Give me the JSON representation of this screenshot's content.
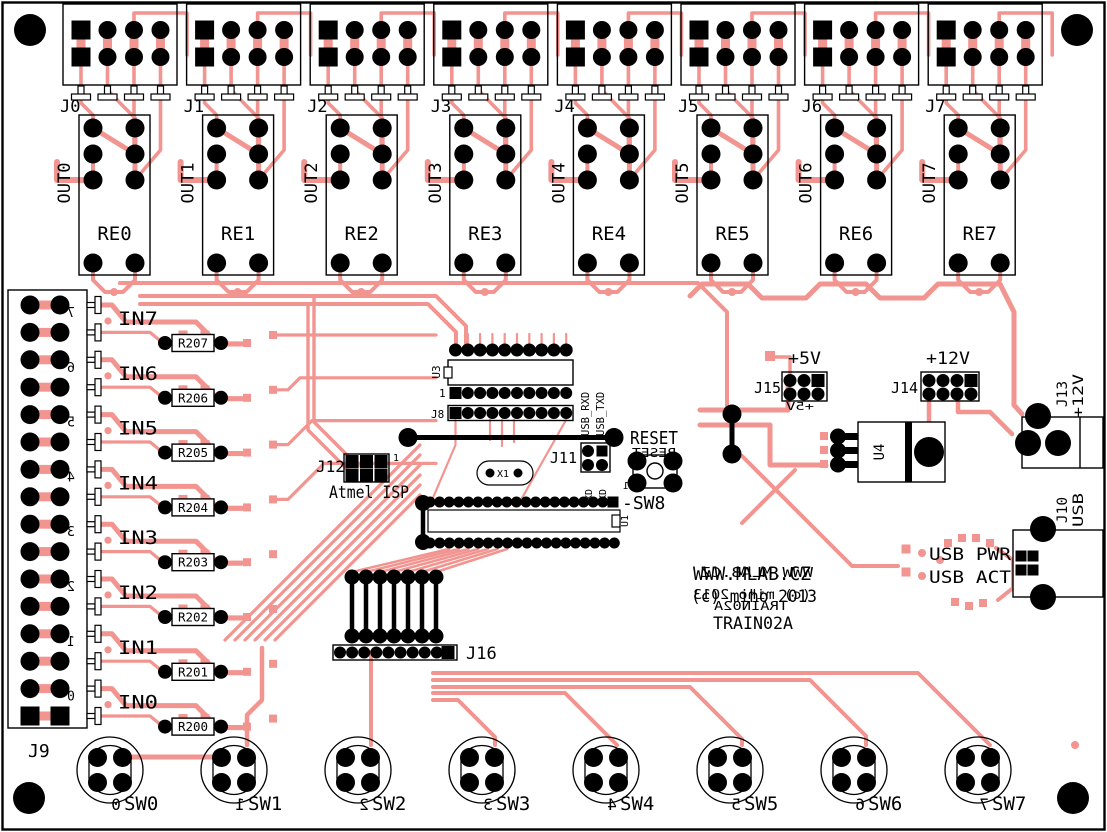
{
  "board_name": "TRAIN02A",
  "colors": {
    "trace": "#f2948f",
    "silk": "#000000",
    "board": "#ffffff"
  },
  "top_connectors": [
    {
      "label": "J0"
    },
    {
      "label": "J1"
    },
    {
      "label": "J2"
    },
    {
      "label": "J3"
    },
    {
      "label": "J4"
    },
    {
      "label": "J5"
    },
    {
      "label": "J6"
    },
    {
      "label": "J7"
    }
  ],
  "relays": [
    {
      "label": "RE0"
    },
    {
      "label": "RE1"
    },
    {
      "label": "RE2"
    },
    {
      "label": "RE3"
    },
    {
      "label": "RE4"
    },
    {
      "label": "RE5"
    },
    {
      "label": "RE6"
    },
    {
      "label": "RE7"
    }
  ],
  "outputs": [
    {
      "label": "OUT0"
    },
    {
      "label": "OUT1"
    },
    {
      "label": "OUT2"
    },
    {
      "label": "OUT3"
    },
    {
      "label": "OUT4"
    },
    {
      "label": "OUT5"
    },
    {
      "label": "OUT6"
    },
    {
      "label": "OUT7"
    }
  ],
  "left_connector": {
    "label": "J9",
    "pin_numbers": [
      "7",
      "6",
      "5",
      "4",
      "3",
      "2",
      "1",
      "0"
    ]
  },
  "inputs": [
    {
      "label": "IN7",
      "resistor": "R207"
    },
    {
      "label": "IN6",
      "resistor": "R206"
    },
    {
      "label": "IN5",
      "resistor": "R205"
    },
    {
      "label": "IN4",
      "resistor": "R204"
    },
    {
      "label": "IN3",
      "resistor": "R203"
    },
    {
      "label": "IN2",
      "resistor": "R202"
    },
    {
      "label": "IN1",
      "resistor": "R201"
    },
    {
      "label": "IN0",
      "resistor": "R200"
    }
  ],
  "switches": [
    {
      "label": "SW0",
      "number": "0"
    },
    {
      "label": "SW1",
      "number": "1"
    },
    {
      "label": "SW2",
      "number": "2"
    },
    {
      "label": "SW3",
      "number": "3"
    },
    {
      "label": "SW4",
      "number": "4"
    },
    {
      "label": "SW5",
      "number": "5"
    },
    {
      "label": "SW6",
      "number": "6"
    },
    {
      "label": "SW7",
      "number": "7"
    }
  ],
  "mcu": {
    "u3": "U3",
    "u1": "U1",
    "j8": "J8",
    "pin1": "1",
    "x1": "X1",
    "j11": "J11",
    "usb_rxd": "USB_RXD",
    "usb_txd": "USB_TXD",
    "txd": "TXD",
    "rxd": "RXD",
    "reset": "RESET",
    "reset_mirror": "RESET",
    "pin1_red": "1",
    "sw8": "-SW8",
    "j12": "J12",
    "isp_caption": "Atmel ISP",
    "j12_pin1": "1",
    "j16": "J16"
  },
  "power": {
    "j15": "J15",
    "plus5": "+5V",
    "plus5_mirror": "+5V",
    "j14": "J14",
    "plus12": "+12V",
    "u4": "U4",
    "j13": "J13",
    "j13_caption": "+12V",
    "j10": "J10",
    "j10_caption": "USB",
    "led_pwr": "USB PWR",
    "led_act": "USB ACT"
  },
  "titleblock": {
    "line1": "WWW.MLAB.CZ",
    "line2": "(c) miho 2013",
    "line3": "TRAIN02A",
    "mirror1": "WWW.MLAB.CZ",
    "mirror2": "(c) miho 2013",
    "mirror3": "TRAIN02A"
  }
}
